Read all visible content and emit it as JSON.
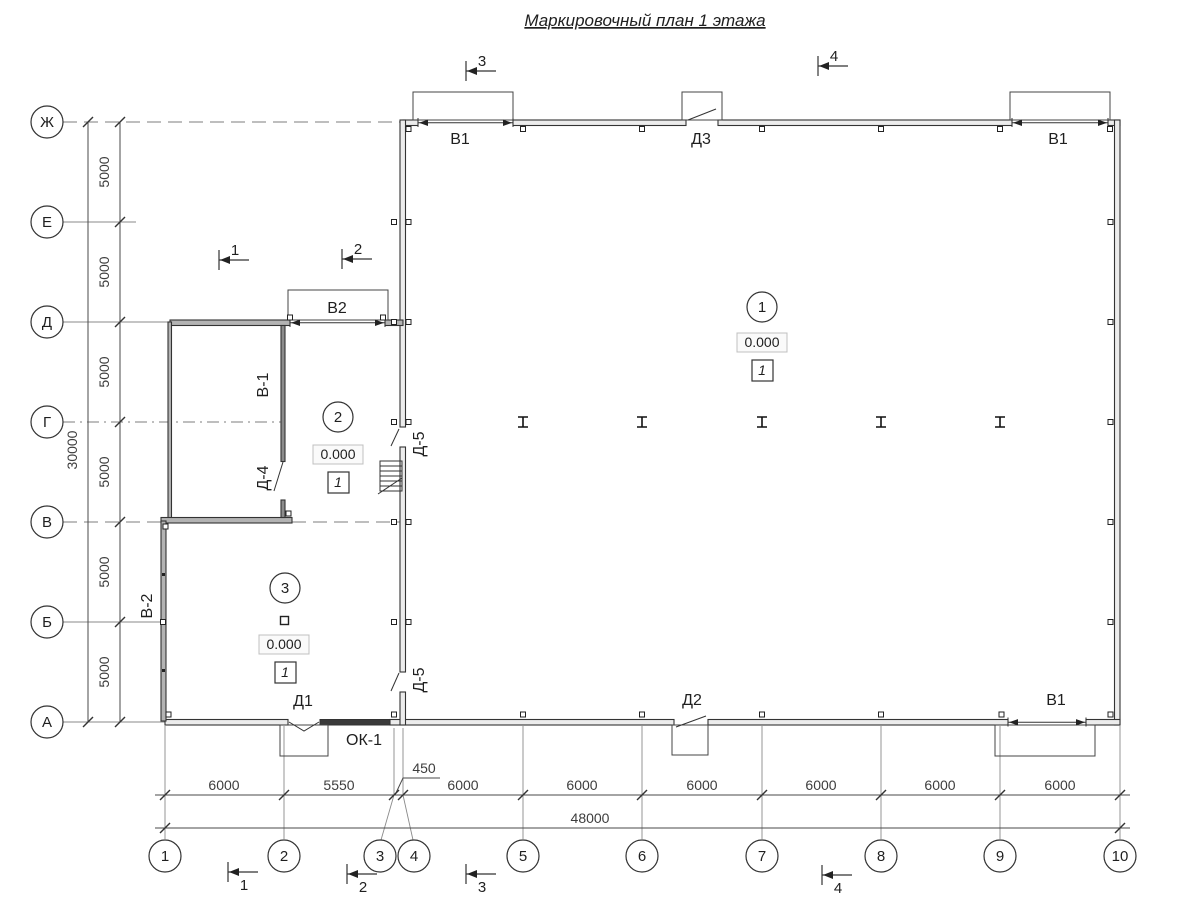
{
  "title": "Маркировочный план 1 этажа",
  "colors": {
    "line": "#333333",
    "dim_text": "#3d3d3d",
    "wall_fill": "#ececec",
    "background": "#ffffff"
  },
  "axes": {
    "rows": [
      "Ж",
      "Е",
      "Д",
      "Г",
      "В",
      "Б",
      "А"
    ],
    "columns": [
      "1",
      "2",
      "3",
      "4",
      "5",
      "6",
      "7",
      "8",
      "9",
      "10"
    ]
  },
  "dims": {
    "left_segments": [
      "5000",
      "5000",
      "5000",
      "5000",
      "5000",
      "5000"
    ],
    "left_total": "30000",
    "bottom_segments": [
      "6000",
      "5550",
      "450",
      "6000",
      "6000",
      "6000",
      "6000",
      "6000",
      "6000"
    ],
    "bottom_total": "48000"
  },
  "sections": {
    "s1": "1",
    "s2": "2",
    "s3": "3",
    "s4": "4"
  },
  "rooms": [
    {
      "num": "1",
      "elevation": "0.000",
      "finish": "1"
    },
    {
      "num": "2",
      "elevation": "0.000",
      "finish": "1"
    },
    {
      "num": "3",
      "elevation": "0.000",
      "finish": "1"
    }
  ],
  "marks": {
    "v1": "В1",
    "v2": "В2",
    "v_1": "В-1",
    "v_2": "В-2",
    "d1": "Д1",
    "d2": "Д2",
    "d3": "Д3",
    "d_4": "Д-4",
    "d_5": "Д-5",
    "ok1": "ОК-1"
  }
}
